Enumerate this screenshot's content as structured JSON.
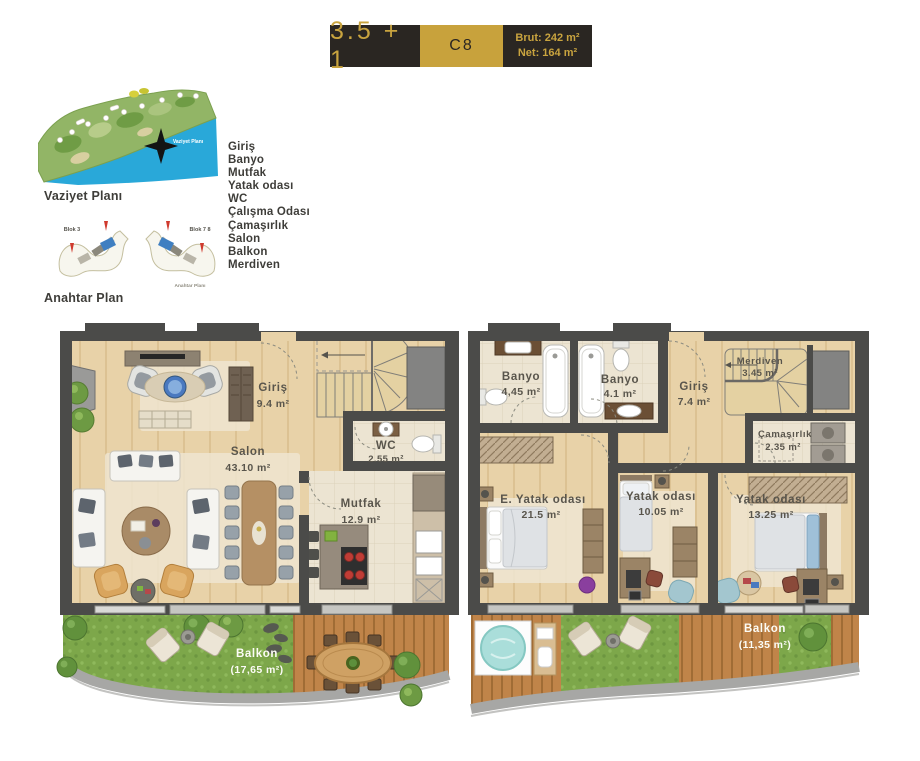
{
  "header": {
    "type_label": "3.5 + 1",
    "unit_code": "C8",
    "brut": "Brut: 242 m²",
    "net": "Net: 164 m²"
  },
  "site_plan": {
    "caption": "Vaziyet Planı",
    "inner_label": "Vaziyet Planı"
  },
  "key_plan": {
    "caption": "Anahtar Plan",
    "inner_label": "Anahtar Planı",
    "block_left": "Blok 3",
    "block_right": "Blok 7 8"
  },
  "legend": {
    "items": [
      "Giriş",
      "Banyo",
      "Mutfak",
      "Yatak odası",
      "WC",
      "Çalışma Odası",
      "Çamaşırlık",
      "Salon",
      "Balkon",
      "Merdiven"
    ]
  },
  "floor1": {
    "rooms": {
      "giris": {
        "name": "Giriş",
        "area": "9.4 m²"
      },
      "salon": {
        "name": "Salon",
        "area": "43.10 m²"
      },
      "wc": {
        "name": "WC",
        "area": "2.55 m²"
      },
      "mutfak": {
        "name": "Mutfak",
        "area": "12.9 m²"
      },
      "balkon": {
        "name": "Balkon",
        "area": "(17,65 m²)"
      }
    }
  },
  "floor2": {
    "rooms": {
      "banyo1": {
        "name": "Banyo",
        "area": "4,45 m²"
      },
      "banyo2": {
        "name": "Banyo",
        "area": "4.1 m²"
      },
      "giris": {
        "name": "Giriş",
        "area": "7.4 m²"
      },
      "merdiven": {
        "name": "Merdiven",
        "area": "3.45 m²"
      },
      "camasirlik": {
        "name": "Çamaşırlık",
        "area": "2.35 m²"
      },
      "e_yatak": {
        "name": "E. Yatak odası",
        "area": "21.5 m²"
      },
      "yatak1": {
        "name": "Yatak odası",
        "area": "10.05 m²"
      },
      "yatak2": {
        "name": "Yatak odası",
        "area": "13.25 m²"
      },
      "balkon": {
        "name": "Balkon",
        "area": "(11,35 m²)"
      }
    }
  },
  "colors": {
    "gold": "#c8a23c",
    "dark": "#2a2622",
    "wall": "#4b4b49",
    "wood": "#e8d2a8",
    "tile": "#ece4d2",
    "grass": "#7da74a",
    "deck": "#c08449",
    "sea": "#29a8d9",
    "highlight_blue": "#3f7fc1",
    "marker_red": "#d03a2e"
  }
}
